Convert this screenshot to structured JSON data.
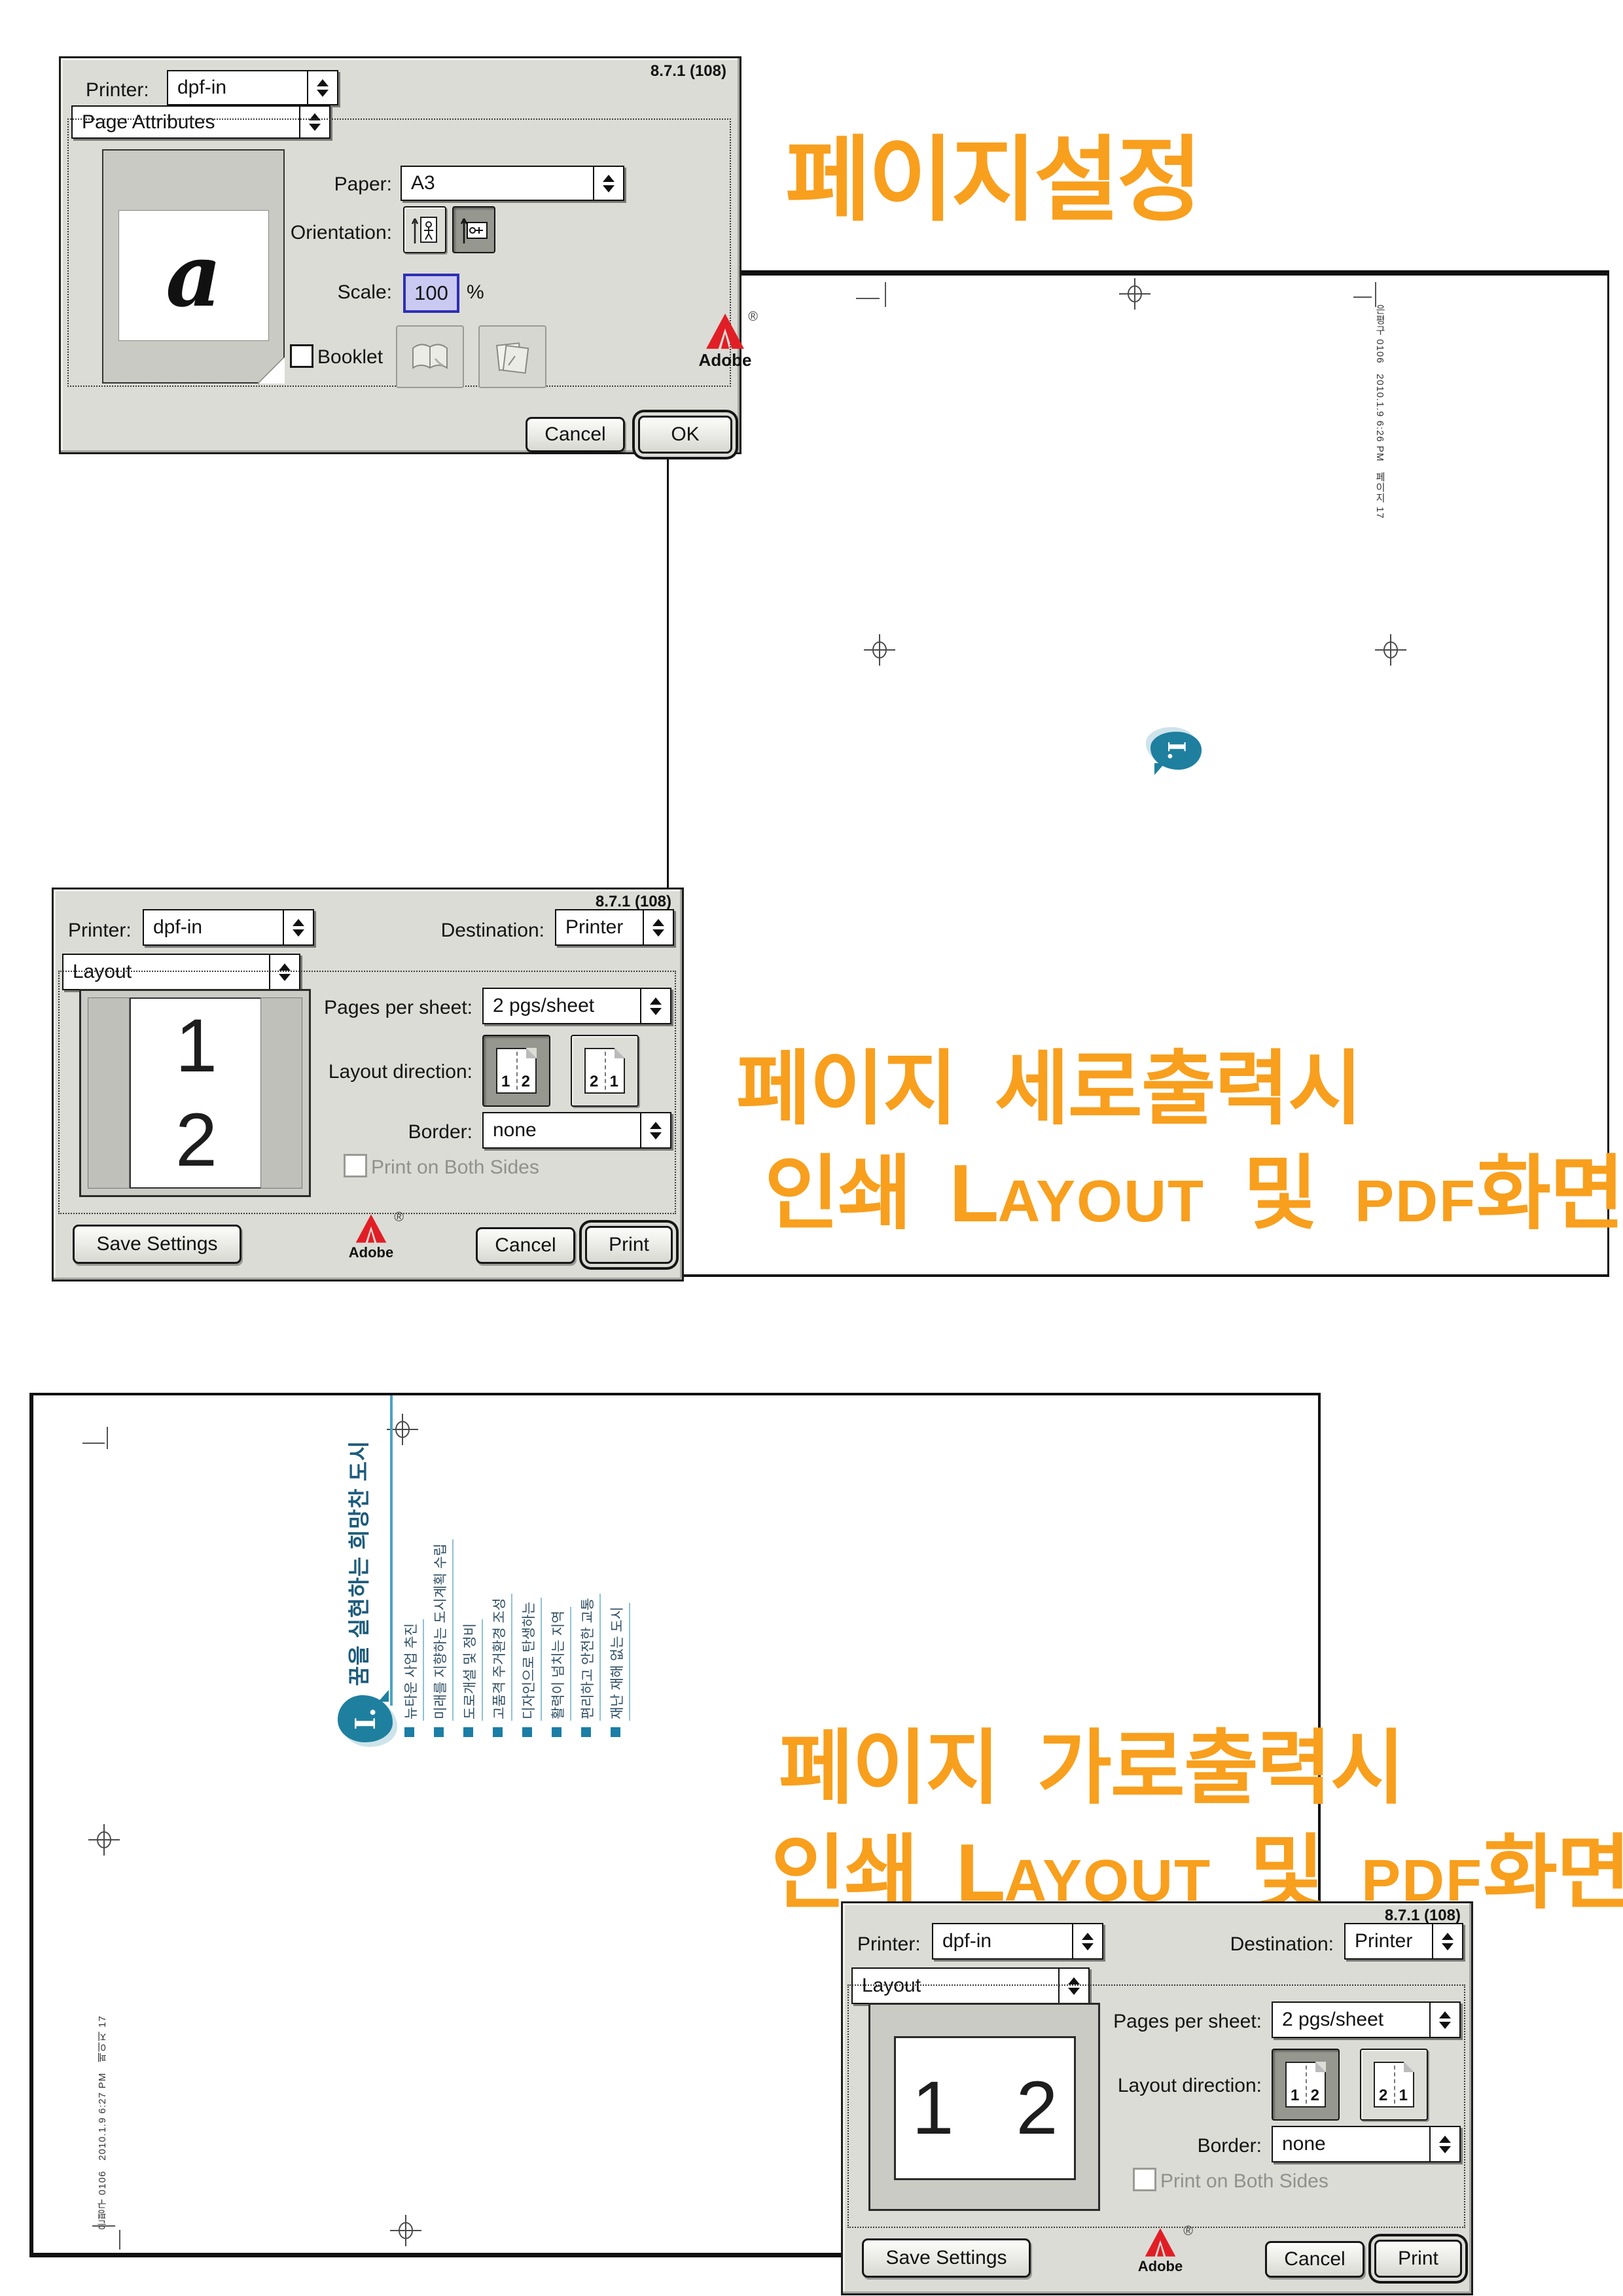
{
  "page_setup_dialog": {
    "version": "8.7.1 (108)",
    "printer_label": "Printer:",
    "printer_value": "dpf-in",
    "panel": "Page Attributes",
    "preview_glyph": "a",
    "paper_label": "Paper:",
    "paper_value": "A3",
    "orientation_label": "Orientation:",
    "scale_label": "Scale:",
    "scale_value": "100",
    "scale_unit": "%",
    "booklet_label": "Booklet",
    "cancel": "Cancel",
    "ok": "OK",
    "adobe": "Adobe",
    "adobe_reg": "®"
  },
  "layout_dialog": {
    "version": "8.7.1 (108)",
    "printer_label": "Printer:",
    "printer_value": "dpf-in",
    "destination_label": "Destination:",
    "destination_value": "Printer",
    "panel": "Layout",
    "pages_per_sheet_label": "Pages per sheet:",
    "pages_per_sheet_value": "2 pgs/sheet",
    "layout_direction_label": "Layout direction:",
    "direction1": {
      "a": "1",
      "b": "2"
    },
    "direction2": {
      "a": "2",
      "b": "1"
    },
    "border_label": "Border:",
    "border_value": "none",
    "both_sides": "Print on Both Sides",
    "save_settings": "Save Settings",
    "cancel": "Cancel",
    "print": "Print",
    "adobe": "Adobe",
    "adobe_reg": "®",
    "preview_page1": "1",
    "preview_page2": "2"
  },
  "annotations": {
    "page_setup_title": "페이지설정",
    "portrait_note_line1": "페이지 세로출력시",
    "landscape_note_line1": "페이지 가로출력시",
    "note_line2": {
      "ko_print": "인쇄",
      "layout_cap": "L",
      "layout_rest": "AYOUT",
      "ko_and": "및",
      "pdf": "PDF",
      "ko_screen": "화면"
    }
  },
  "pdf_portrait_page": {
    "slug": "은평구 0106   2010.1.9 6:26 PM   페이지 17",
    "bubble_numeral": "I."
  },
  "pdf_landscape_page": {
    "slug": "은평구 0106   2010.1.9 6:27 PM   페이지 17",
    "bubble_numeral": "I.",
    "title": "꿈을 실현하는 희망찬 도시",
    "items": [
      "뉴타운 사업 추진",
      "미래를 지향하는 도시계획 수립",
      "도로개설 및 정비",
      "고품격 주거환경 조성",
      "디자인으로 탄생하는",
      "활력이 넘치는 지역",
      "편리하고 안전한 교통",
      "재난 재해 없는 도시"
    ]
  },
  "colors": {
    "accent_orange": "#F89F1D",
    "bubble_teal": "#1E7F9F",
    "content_title": "#1D5C7C",
    "content_rule": "#4AA3C4",
    "content_bullet": "#1B7EA6",
    "adobe_red": "#E11E26"
  }
}
